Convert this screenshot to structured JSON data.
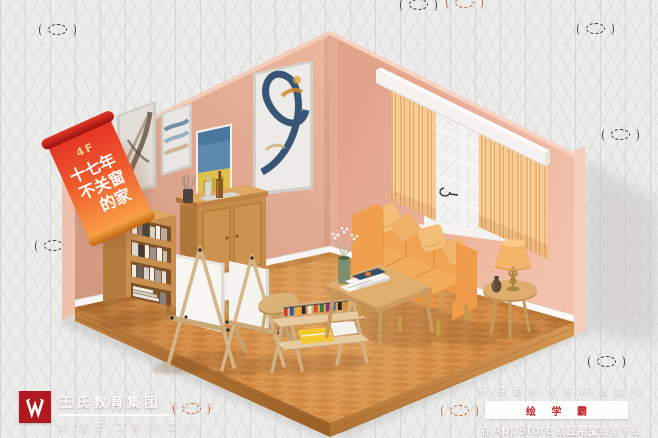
{
  "branding": {
    "company": "王氏教育集团",
    "slogan": "以人为本",
    "since": "始创于二零零二年",
    "logo_letter": "W",
    "logo_color": "#b2191e"
  },
  "hanging_banner": {
    "floor_label": "4F",
    "line1": "十七年",
    "line2": "不关窗",
    "line3": "的家"
  },
  "promo": {
    "headline": "获得更多免费精品教程",
    "app_name": "绘 学 霸",
    "download_prefix": "在",
    "store1": "AppStore",
    "conjunction": "或",
    "store2": "应用宝",
    "download_suffix": "搜索下载",
    "app_accent_color": "#c1292b"
  },
  "scene_colors": {
    "background": "#ecedeb",
    "wall_pink": "#e8b09a",
    "floor_wood": "#d08540",
    "sofa_orange": "#efa050",
    "curtain_peach": "#f6c795",
    "banner_red": "#e63226"
  }
}
